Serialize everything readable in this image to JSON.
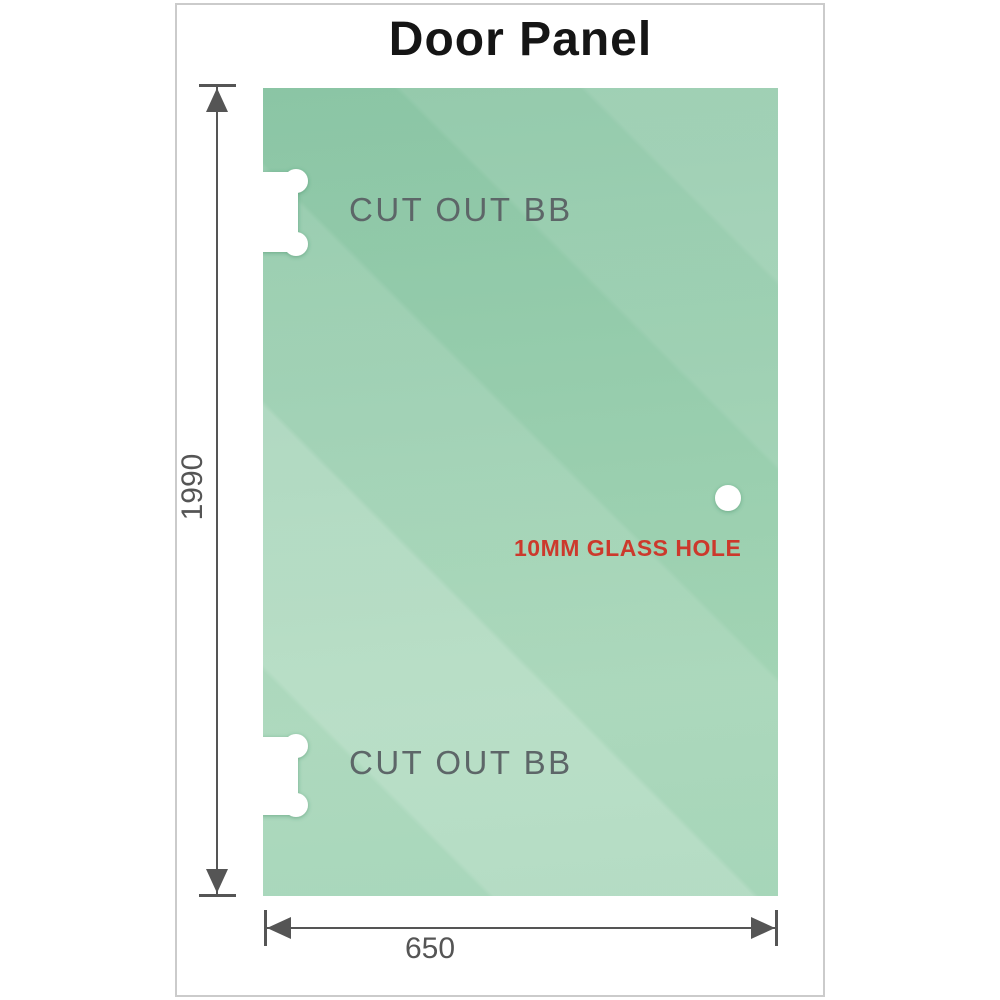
{
  "title": "Door Panel",
  "panel": {
    "cutout_top_label": "CUT OUT BB",
    "cutout_bottom_label": "CUT OUT BB",
    "glass_hole_label": "10MM GLASS HOLE"
  },
  "dimensions": {
    "height_value": "1990",
    "width_value": "650"
  },
  "colors": {
    "glass_green": "#93cbaa",
    "hole_label_red": "#cc392c",
    "dimension_gray": "#555555",
    "cutout_text_gray": "#5d6668",
    "frame_border": "#cbcbcb"
  }
}
